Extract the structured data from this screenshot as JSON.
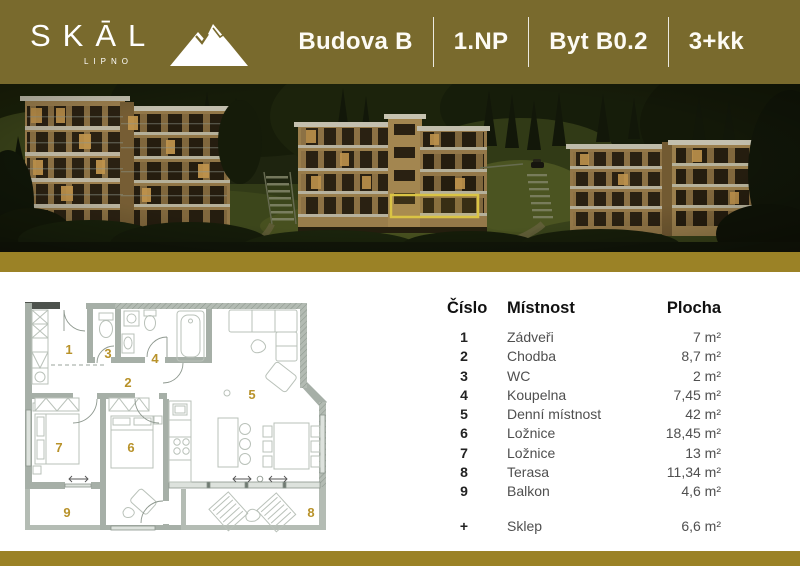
{
  "header": {
    "logo": {
      "brand": "SKĀL",
      "subtitle": "LIPNO"
    },
    "unit": {
      "building": "Budova B",
      "floor": "1.NP",
      "apartment": "Byt B0.2",
      "layout": "3+kk"
    }
  },
  "photo": {
    "highlight_color": "#eed64b"
  },
  "table": {
    "headers": {
      "number": "Číslo",
      "room": "Místnost",
      "area": "Plocha"
    },
    "rows": [
      {
        "num": "1",
        "room": "Zádveři",
        "area": "7 m²"
      },
      {
        "num": "2",
        "room": "Chodba",
        "area": "8,7 m²"
      },
      {
        "num": "3",
        "room": "WC",
        "area": "2 m²"
      },
      {
        "num": "4",
        "room": "Koupelna",
        "area": "7,45 m²"
      },
      {
        "num": "5",
        "room": "Denní místnost",
        "area": "42 m²"
      },
      {
        "num": "6",
        "room": "Ložnice",
        "area": "18,45 m²"
      },
      {
        "num": "7",
        "room": "Ložnice",
        "area": "13 m²"
      },
      {
        "num": "8",
        "room": "Terasa",
        "area": "11,34 m²"
      },
      {
        "num": "9",
        "room": "Balkon",
        "area": "4,6 m²"
      }
    ],
    "extra_row": {
      "num": "+",
      "room": "Sklep",
      "area": "6,6 m²"
    }
  },
  "colors": {
    "header_bg": "#796a2d",
    "bar_gold": "#9b8226",
    "accent_gold": "#b8922a",
    "text_dark": "#1c1c1c",
    "text_muted": "#4f4f4f"
  }
}
